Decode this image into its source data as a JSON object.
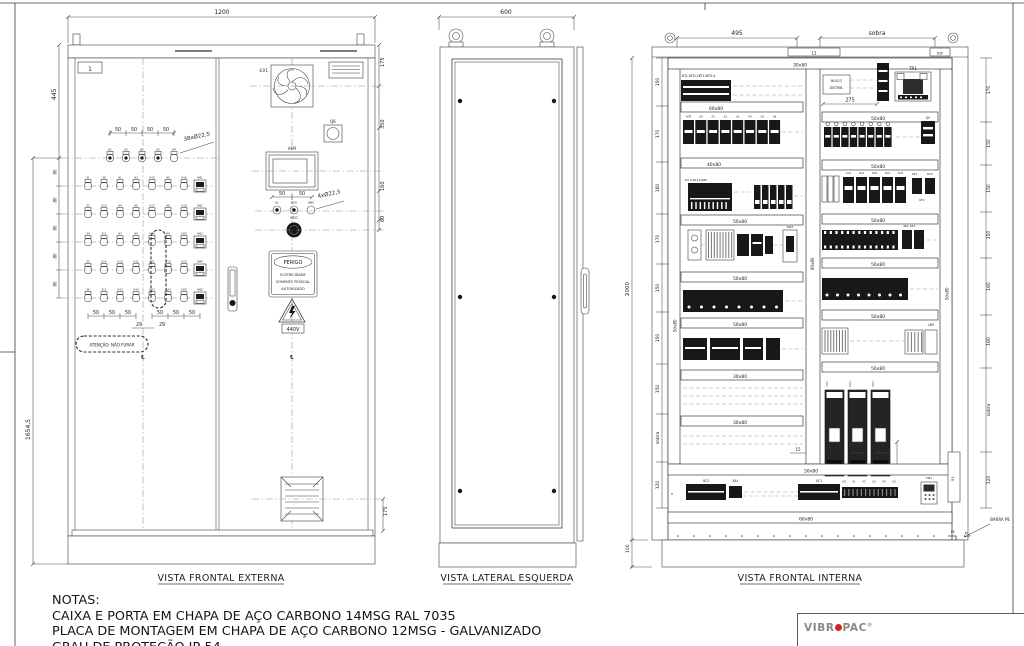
{
  "notes": {
    "title": "NOTAS:",
    "line1": "CAIXA E PORTA EM CHAPA DE AÇO CARBONO 14MSG RAL 7035",
    "line2": "PLACA DE MONTAGEM EM CHAPA DE AÇO CARBONO 12MSG - GALVANIZADO",
    "line3": "GRAU DE PROTEÇÃO IP-54"
  },
  "logo": {
    "left": "VIBR",
    "right": "PAC",
    "reg": "®"
  },
  "views": {
    "external": {
      "title": "VISTA FRONTAL EXTERNA",
      "dim_width": "1200",
      "dim_445": "445",
      "dim_total": "1654,5",
      "dim_175_top": "175",
      "dim_350": "350",
      "dim_160": "160",
      "dim_80": "80",
      "dim_175_bottom": "175",
      "dim_29_a": "29",
      "dim_29_b": "29",
      "btn_spacing": [
        "50",
        "50",
        "50",
        "50"
      ],
      "grid_dims_80": [
        "80",
        "80",
        "80",
        "80",
        "80"
      ],
      "bottom_50s": [
        "50",
        "50",
        "50",
        "50",
        "50",
        "50"
      ],
      "ihm_dim_a": "50",
      "ihm_dim_b": "50",
      "callout_38": "38xØ22,5",
      "callout_4": "4xØ22,5",
      "doc_label": "1",
      "fan_label": "-EX1",
      "switch_label": "Q6",
      "hmi_label": "IHM",
      "small_buttons": [
        "AL",
        "BSA",
        "HBS"
      ],
      "emergency_label": "BEG",
      "danger_title": "PERIGO",
      "danger_lines": [
        "ELETRICIDADE",
        "SOMENTE PESSOAL",
        "AUTORIZADO"
      ],
      "voltage_label": "440V",
      "attention_label": "ATENÇÃO: NÃO FURAR",
      "centerline_glyph": "℄",
      "button_grid": {
        "top_row": [
          "H1",
          "H2",
          "B1",
          "H3",
          "H4"
        ],
        "rows": [
          [
            "S1",
            "S8",
            "H1",
            "H3",
            "H15",
            "H5",
            "H16",
            "HB1"
          ],
          [
            "S2",
            "S10",
            "H4",
            "H6",
            "H17",
            "H8",
            "H18",
            "HB2"
          ],
          [
            "S4",
            "S11",
            "H7",
            "H9",
            "H19",
            "H9",
            "H20",
            "HB3"
          ],
          [
            "S5",
            "S14",
            "H10",
            "H11",
            "H21",
            "H12",
            "H22",
            "HB4"
          ],
          [
            "S6",
            "S13",
            "H13",
            "H14",
            "H23",
            "H24",
            "H25",
            "HB5"
          ]
        ]
      }
    },
    "side": {
      "title": "VISTA LATERAL ESQUERDA",
      "dim_width": "600"
    },
    "internal": {
      "title": "VISTA FRONTAL INTERNA",
      "dim_495": "495",
      "dim_sobra_top": "sobra",
      "dim_2000": "2000",
      "dim_100": "100",
      "dim_275": "275",
      "left_dims": [
        "150",
        "170",
        "160",
        "170",
        "150",
        "150",
        "150",
        "sobra",
        "120"
      ],
      "right_dims": [
        "170",
        "150",
        "150",
        "150",
        "160",
        "160",
        "sobra",
        "120"
      ],
      "dim_15": [
        "15",
        "15",
        "15"
      ],
      "roof_box_left": "L1",
      "roof_box_right": "X2F",
      "duct_top": "30x80",
      "duct_60": "60x80",
      "duct_40": "40x80",
      "duct_50a": "50x80",
      "duct_50b": "50x80",
      "duct_50c": "50x80",
      "duct_30a": "30x80",
      "duct_30b": "30x80",
      "duct_50d": "50x80",
      "duct_50e": "50x80",
      "duct_50f": "50x80",
      "duct_50g": "50x80",
      "duct_50h": "50x80",
      "duct_50i": "50x80",
      "duct_50full": "50x80",
      "duct_bottom": "60x80",
      "duct_center": "80x80",
      "duct_side_l": "50x80",
      "duct_side_r": "50x80",
      "ktl_label": "KTL1KTL2KTL3KTL4",
      "breakers_a": [
        "AGP",
        "A0",
        "A1",
        "A2",
        "A3",
        "A4",
        "A5",
        "A6"
      ],
      "ku_label": "KU A BL11/JMP",
      "swt_label": "SWT",
      "bloco_line1": "BLOCO",
      "bloco_line2": "DISTRIB.",
      "tr_label": "TR1",
      "q0_label": "Q0",
      "q_row": [
        "1Q1",
        "2Q1",
        "3Q1",
        "4Q1",
        "5Q1"
      ],
      "kf1": "KF1",
      "kf3": "KF3",
      "kf2": "KF2",
      "contactors": "4K1  5K1",
      "lb_label": "LB5",
      "vfds": [
        "1U1",
        "2U1",
        "3U1"
      ],
      "xc2": "XC2",
      "xai": "XAI",
      "xc1": "XC1",
      "term_right": [
        "X0",
        "X1",
        "X2",
        "X3",
        "X4",
        "X5"
      ],
      "tm_label": "TM1",
      "r1_label": "R1",
      "pe_label": "PE",
      "barra_pe": "BARRA PE"
    }
  }
}
